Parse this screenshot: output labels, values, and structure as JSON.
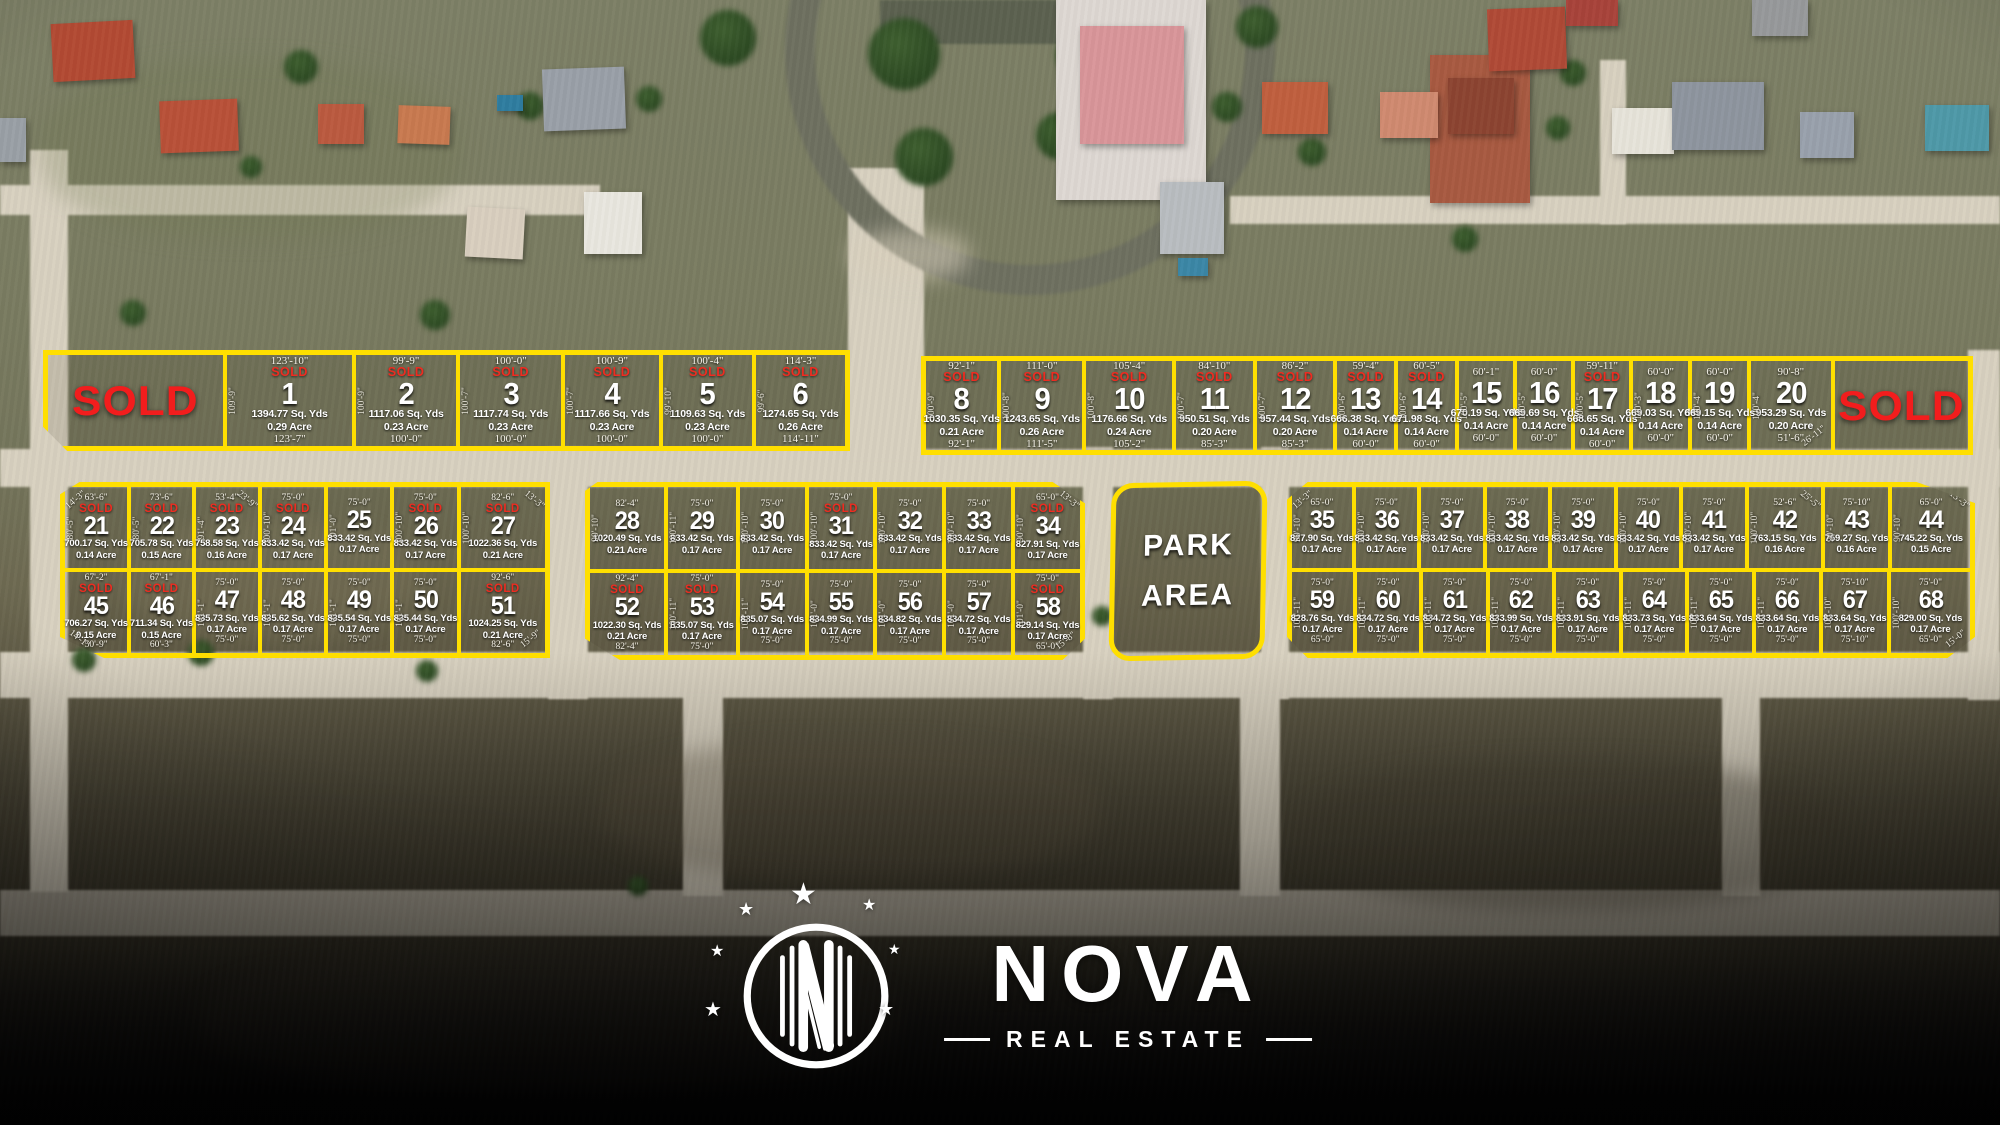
{
  "branding": {
    "name": "NOVA",
    "tagline": "REAL ESTATE"
  },
  "park": {
    "line1": "PARK",
    "line2": "AREA"
  },
  "colors": {
    "parcel_outline": "#ffdf00",
    "sold_red": "#ee2c21",
    "sold_red_large": "#f21d1d",
    "text_white": "#ffffff"
  },
  "map": {
    "sold_label": "SOLD",
    "blocks": [
      {
        "name": "block-lots-1-6",
        "x": 43,
        "y": 350,
        "w": 807,
        "h": 101,
        "clip": "polygon(0 0,100% 0,100% 100%,3% 100%,0 76%)",
        "rows": [
          [
            {
              "type": "sold",
              "wt": 183
            },
            {
              "num": "1",
              "sold": true,
              "top": "123'-10\"",
              "bottom": "123'-7\"",
              "side": "109'-9\"",
              "area": "1394.77 Sq. Yds",
              "acre": "0.29 Acre",
              "wt": 130
            },
            {
              "num": "2",
              "sold": true,
              "top": "99'-9\"",
              "bottom": "100'-0\"",
              "side": "100'-9\"",
              "area": "1117.06 Sq. Yds",
              "acre": "0.23 Acre",
              "wt": 105
            },
            {
              "num": "3",
              "sold": true,
              "top": "100'-0\"",
              "bottom": "100'-0\"",
              "side": "100'-7\"",
              "area": "1117.74 Sq. Yds",
              "acre": "0.23 Acre",
              "wt": 105
            },
            {
              "num": "4",
              "sold": true,
              "top": "100'-9\"",
              "bottom": "100'-0\"",
              "side": "100'-7\"",
              "area": "1117.66 Sq. Yds",
              "acre": "0.23 Acre",
              "wt": 98
            },
            {
              "num": "5",
              "sold": true,
              "top": "100'-4\"",
              "bottom": "100'-0\"",
              "side": "99'-10\"",
              "area": "1109.63 Sq. Yds",
              "acre": "0.23 Acre",
              "wt": 93
            },
            {
              "num": "6",
              "sold": true,
              "top": "114'-3\"",
              "bottom": "114'-11\"",
              "side": "99'-6\"",
              "area": "1274.65 Sq. Yds",
              "acre": "0.26 Acre",
              "wt": 93
            }
          ]
        ]
      },
      {
        "name": "block-lots-8-20",
        "x": 921,
        "y": 356,
        "w": 1052,
        "h": 99,
        "rows": [
          [
            {
              "num": "8",
              "sold": true,
              "top": "92'-1\"",
              "bottom": "92'-1\"",
              "side": "100'-9\"",
              "area": "1030.35 Sq. Yds",
              "acre": "0.21 Acre",
              "wt": 79
            },
            {
              "num": "9",
              "sold": true,
              "top": "111'-0\"",
              "bottom": "111'-5\"",
              "side": "100'-8\"",
              "area": "1243.65 Sq. Yds",
              "acre": "0.26 Acre",
              "wt": 90
            },
            {
              "num": "10",
              "sold": true,
              "top": "105'-4\"",
              "bottom": "105'-2\"",
              "side": "100'-8\"",
              "area": "1176.66 Sq. Yds",
              "acre": "0.24 Acre",
              "wt": 95
            },
            {
              "num": "11",
              "sold": true,
              "top": "84'-10\"",
              "bottom": "85'-3\"",
              "side": "100'-7\"",
              "area": "950.51 Sq. Yds",
              "acre": "0.20 Acre",
              "wt": 85
            },
            {
              "num": "12",
              "sold": true,
              "top": "86'-2\"",
              "bottom": "85'-3\"",
              "side": "100'-7\"",
              "area": "957.44 Sq. Yds",
              "acre": "0.20 Acre",
              "wt": 85
            },
            {
              "num": "13",
              "sold": true,
              "top": "59'-4\"",
              "bottom": "60'-0\"",
              "side": "100'-6\"",
              "area": "666.38 Sq. Yds",
              "acre": "0.14 Acre",
              "wt": 63
            },
            {
              "num": "14",
              "sold": true,
              "top": "60'-5\"",
              "bottom": "60'-0\"",
              "side": "100'-6\"",
              "area": "671.98 Sq. Yds",
              "acre": "0.14 Acre",
              "wt": 63
            },
            {
              "num": "15",
              "top": "60'-1\"",
              "bottom": "60'-0\"",
              "side": "100'-5\"",
              "area": "670.19 Sq. Yds",
              "acre": "0.14 Acre",
              "wt": 60
            },
            {
              "num": "16",
              "top": "60'-0\"",
              "bottom": "60'-0\"",
              "side": "100'-5\"",
              "area": "669.69 Sq. Yds",
              "acre": "0.14 Acre",
              "wt": 60
            },
            {
              "num": "17",
              "sold": true,
              "top": "59'-11\"",
              "bottom": "60'-0\"",
              "side": "100'-5\"",
              "area": "668.65 Sq. Yds",
              "acre": "0.14 Acre",
              "wt": 60
            },
            {
              "num": "18",
              "top": "60'-0\"",
              "bottom": "60'-0\"",
              "side": "100'-3\"",
              "area": "669.03 Sq. Yds",
              "acre": "0.14 Acre",
              "wt": 61
            },
            {
              "num": "19",
              "top": "60'-0\"",
              "bottom": "60'-0\"",
              "side": "100'-4\"",
              "area": "669.15 Sq. Yds",
              "acre": "0.14 Acre",
              "wt": 61
            },
            {
              "num": "20",
              "top": "90'-8\"",
              "bottom": "51'-6\"",
              "side": "100'-4\"",
              "diag": "26'-11\"",
              "diag_pos": "br",
              "area": "953.29 Sq. Yds",
              "acre": "0.20 Acre",
              "wt": 88
            },
            {
              "type": "sold",
              "wt": 148
            }
          ]
        ]
      },
      {
        "name": "block-lots-21-27-45-51",
        "x": 60,
        "y": 482,
        "w": 490,
        "h": 176,
        "clip": "polygon(4% 0,100% 0,100% 100%,9% 100%,0 88%,0 7%)",
        "rows": [
          [
            {
              "num": "21",
              "sold": true,
              "top": "63'-6\"",
              "side": "80'-5\"",
              "diag": "14'-3\"",
              "diag_pos": "tl",
              "area": "700.17 Sq. Yds",
              "acre": "0.14 Acre",
              "wt": 70
            },
            {
              "num": "22",
              "sold": true,
              "top": "73'-6\"",
              "side": "80'-5\"",
              "area": "705.78 Sq. Yds",
              "acre": "0.15 Acre",
              "wt": 68
            },
            {
              "num": "23",
              "sold": true,
              "top": "53'-4\"",
              "side": "91'-4\"",
              "diag": "23'-9\"",
              "diag_pos": "tr",
              "area": "758.58 Sq. Yds",
              "acre": "0.16 Acre",
              "wt": 70
            },
            {
              "num": "24",
              "sold": true,
              "top": "75'-0\"",
              "side": "100'-10\"",
              "area": "833.42 Sq. Yds",
              "acre": "0.17 Acre",
              "wt": 70
            },
            {
              "num": "25",
              "top": "75'-0\"",
              "side": "101'-0\"",
              "area": "833.42 Sq. Yds",
              "acre": "0.17 Acre",
              "wt": 70
            },
            {
              "num": "26",
              "sold": true,
              "top": "75'-0\"",
              "side": "100'-10\"",
              "area": "833.42 Sq. Yds",
              "acre": "0.17 Acre",
              "wt": 70
            },
            {
              "num": "27",
              "sold": true,
              "top": "82'-6\"",
              "side": "100'-10\"",
              "diag": "13'-3\"",
              "diag_pos": "tr",
              "area": "1022.36 Sq. Yds",
              "acre": "0.21 Acre",
              "wt": 95
            }
          ],
          [
            {
              "num": "45",
              "sold": true,
              "top": "67'-2\"",
              "bottom": "50'-9\"",
              "diag": "14'-1\"",
              "diag_pos": "bl",
              "area": "706.27 Sq. Yds",
              "acre": "0.15 Acre",
              "wt": 70
            },
            {
              "num": "46",
              "sold": true,
              "top": "67'-1\"",
              "bottom": "60'-3\"",
              "area": "711.34 Sq. Yds",
              "acre": "0.15 Acre",
              "wt": 68
            },
            {
              "num": "47",
              "top": "75'-0\"",
              "bottom": "75'-0\"",
              "side": "101'-1\"",
              "area": "835.73 Sq. Yds",
              "acre": "0.17 Acre",
              "wt": 70
            },
            {
              "num": "48",
              "top": "75'-0\"",
              "bottom": "75'-0\"",
              "side": "101'-1\"",
              "area": "835.62 Sq. Yds",
              "acre": "0.17 Acre",
              "wt": 70
            },
            {
              "num": "49",
              "top": "75'-0\"",
              "bottom": "75'-0\"",
              "side": "101'-1\"",
              "area": "835.54 Sq. Yds",
              "acre": "0.17 Acre",
              "wt": 70
            },
            {
              "num": "50",
              "top": "75'-0\"",
              "bottom": "75'-0\"",
              "side": "101'-1\"",
              "area": "835.44 Sq. Yds",
              "acre": "0.17 Acre",
              "wt": 70
            },
            {
              "num": "51",
              "sold": true,
              "top": "92'-6\"",
              "bottom": "82'-6\"",
              "diag": "15'-9\"",
              "diag_pos": "br",
              "area": "1024.25 Sq. Yds",
              "acre": "0.21 Acre",
              "wt": 95
            }
          ]
        ]
      },
      {
        "name": "block-lots-28-34-52-58",
        "x": 585,
        "y": 482,
        "w": 500,
        "h": 178,
        "clip": "polygon(2.5% 0,93.5% 0,100% 12%,100% 88%,95.5% 100%,7% 100%,0 88%,0 5%)",
        "rows": [
          [
            {
              "num": "28",
              "top": "82'-4\"",
              "side": "90'-10\"",
              "area": "1020.49 Sq. Yds",
              "acre": "0.21 Acre",
              "wt": 80
            },
            {
              "num": "29",
              "top": "75'-0\"",
              "side": "100'-11\"",
              "area": "833.42 Sq. Yds",
              "acre": "0.17 Acre",
              "wt": 73
            },
            {
              "num": "30",
              "top": "75'-0\"",
              "side": "100'-10\"",
              "area": "833.42 Sq. Yds",
              "acre": "0.17 Acre",
              "wt": 70
            },
            {
              "num": "31",
              "sold": true,
              "top": "75'-0\"",
              "side": "100'-10\"",
              "area": "833.42 Sq. Yds",
              "acre": "0.17 Acre",
              "wt": 70
            },
            {
              "num": "32",
              "top": "75'-0\"",
              "side": "100'-10\"",
              "area": "833.42 Sq. Yds",
              "acre": "0.17 Acre",
              "wt": 70
            },
            {
              "num": "33",
              "top": "75'-0\"",
              "side": "100'-10\"",
              "area": "833.42 Sq. Yds",
              "acre": "0.17 Acre",
              "wt": 70
            },
            {
              "num": "34",
              "sold": true,
              "top": "65'-0\"",
              "side": "90'-10\"",
              "diag": "13'-3\"",
              "diag_pos": "tr",
              "area": "827.91 Sq. Yds",
              "acre": "0.17 Acre",
              "wt": 70
            }
          ],
          [
            {
              "num": "52",
              "sold": true,
              "top": "92'-4\"",
              "bottom": "82'-4\"",
              "area": "1022.30 Sq. Yds",
              "acre": "0.21 Acre",
              "wt": 80
            },
            {
              "num": "53",
              "sold": true,
              "top": "75'-0\"",
              "bottom": "75'-0\"",
              "side": "100'-11\"",
              "area": "835.07 Sq. Yds",
              "acre": "0.17 Acre",
              "wt": 73
            },
            {
              "num": "54",
              "top": "75'-0\"",
              "bottom": "75'-0\"",
              "side": "100'-11\"",
              "area": "835.07 Sq. Yds",
              "acre": "0.17 Acre",
              "wt": 70
            },
            {
              "num": "55",
              "top": "75'-0\"",
              "bottom": "75'-0\"",
              "side": "101'-0\"",
              "area": "834.99 Sq. Yds",
              "acre": "0.17 Acre",
              "wt": 70
            },
            {
              "num": "56",
              "top": "75'-0\"",
              "bottom": "75'-0\"",
              "side": "101'-0\"",
              "area": "834.82 Sq. Yds",
              "acre": "0.17 Acre",
              "wt": 70
            },
            {
              "num": "57",
              "top": "75'-0\"",
              "bottom": "75'-0\"",
              "side": "101'-0\"",
              "area": "834.72 Sq. Yds",
              "acre": "0.17 Acre",
              "wt": 70
            },
            {
              "num": "58",
              "sold": true,
              "top": "75'-0\"",
              "bottom": "65'-0\"",
              "side": "101'-0\"",
              "diag": "15'-8\"",
              "diag_pos": "br",
              "area": "829.14 Sq. Yds",
              "acre": "0.17 Acre",
              "wt": 70
            }
          ]
        ]
      },
      {
        "name": "park-area",
        "type": "park",
        "x": 1110,
        "y": 482,
        "w": 156,
        "h": 178
      },
      {
        "name": "block-lots-35-44-59-68",
        "x": 1287,
        "y": 482,
        "w": 688,
        "h": 176,
        "clip": "polygon(3% 0,91.5% 0,100% 12%,100% 88%,96% 100%,3% 100%,0 88%,0 10%)",
        "rows": [
          [
            {
              "num": "35",
              "top": "65'-0\"",
              "side": "90'-10\"",
              "diag": "13'-3\"",
              "diag_pos": "tl",
              "area": "827.90 Sq. Yds",
              "acre": "0.17 Acre",
              "wt": 66
            },
            {
              "num": "36",
              "top": "75'-0\"",
              "side": "100'-10\"",
              "area": "833.42 Sq. Yds",
              "acre": "0.17 Acre",
              "wt": 68
            },
            {
              "num": "37",
              "top": "75'-0\"",
              "side": "100'-10\"",
              "area": "833.42 Sq. Yds",
              "acre": "0.17 Acre",
              "wt": 68
            },
            {
              "num": "38",
              "top": "75'-0\"",
              "side": "100'-10\"",
              "area": "833.42 Sq. Yds",
              "acre": "0.17 Acre",
              "wt": 68
            },
            {
              "num": "39",
              "top": "75'-0\"",
              "side": "100'-10\"",
              "area": "833.42 Sq. Yds",
              "acre": "0.17 Acre",
              "wt": 68
            },
            {
              "num": "40",
              "top": "75'-0\"",
              "side": "100'-10\"",
              "area": "833.42 Sq. Yds",
              "acre": "0.17 Acre",
              "wt": 68
            },
            {
              "num": "41",
              "top": "75'-0\"",
              "side": "100'-10\"",
              "area": "833.42 Sq. Yds",
              "acre": "0.17 Acre",
              "wt": 68
            },
            {
              "num": "42",
              "top": "52'-6\"",
              "side": "100'-10\"",
              "diag": "25'-5\"",
              "diag_pos": "tr",
              "area": "763.15 Sq. Yds",
              "acre": "0.16 Acre",
              "wt": 80
            },
            {
              "num": "43",
              "top": "75'-10\"",
              "side": "90'-10\"",
              "area": "759.27 Sq. Yds",
              "acre": "0.16 Acre",
              "wt": 70
            },
            {
              "num": "44",
              "top": "65'-0\"",
              "side": "90'-10\"",
              "diag": "13'-3\"",
              "diag_pos": "tr",
              "area": "745.22 Sq. Yds",
              "acre": "0.15 Acre",
              "wt": 86
            }
          ],
          [
            {
              "num": "59",
              "top": "75'-0\"",
              "bottom": "65'-0\"",
              "side": "100'-11\"",
              "area": "828.76 Sq. Yds",
              "acre": "0.17 Acre",
              "wt": 66
            },
            {
              "num": "60",
              "top": "75'-0\"",
              "bottom": "75'-0\"",
              "side": "100'-11\"",
              "area": "834.72 Sq. Yds",
              "acre": "0.17 Acre",
              "wt": 68
            },
            {
              "num": "61",
              "top": "75'-0\"",
              "bottom": "75'-0\"",
              "side": "100'-11\"",
              "area": "834.72 Sq. Yds",
              "acre": "0.17 Acre",
              "wt": 68
            },
            {
              "num": "62",
              "top": "75'-0\"",
              "bottom": "75'-0\"",
              "side": "100'-11\"",
              "area": "833.99 Sq. Yds",
              "acre": "0.17 Acre",
              "wt": 68
            },
            {
              "num": "63",
              "top": "75'-0\"",
              "bottom": "75'-0\"",
              "side": "100'-11\"",
              "area": "833.91 Sq. Yds",
              "acre": "0.17 Acre",
              "wt": 68
            },
            {
              "num": "64",
              "top": "75'-0\"",
              "bottom": "75'-0\"",
              "side": "100'-11\"",
              "area": "833.73 Sq. Yds",
              "acre": "0.17 Acre",
              "wt": 68
            },
            {
              "num": "65",
              "top": "75'-0\"",
              "bottom": "75'-0\"",
              "side": "100'-11\"",
              "area": "833.64 Sq. Yds",
              "acre": "0.17 Acre",
              "wt": 68
            },
            {
              "num": "66",
              "top": "75'-0\"",
              "bottom": "75'-0\"",
              "side": "100'-11\"",
              "area": "833.64 Sq. Yds",
              "acre": "0.17 Acre",
              "wt": 68
            },
            {
              "num": "67",
              "top": "75'-10\"",
              "bottom": "75'-10\"",
              "side": "100'-10\"",
              "area": "833.64 Sq. Yds",
              "acre": "0.17 Acre",
              "wt": 70
            },
            {
              "num": "68",
              "top": "75'-0\"",
              "bottom": "65'-0\"",
              "side": "100'-10\"",
              "diag": "15'-0\"",
              "diag_pos": "br",
              "area": "829.00 Sq. Yds",
              "acre": "0.17 Acre",
              "wt": 86
            }
          ]
        ]
      }
    ]
  }
}
